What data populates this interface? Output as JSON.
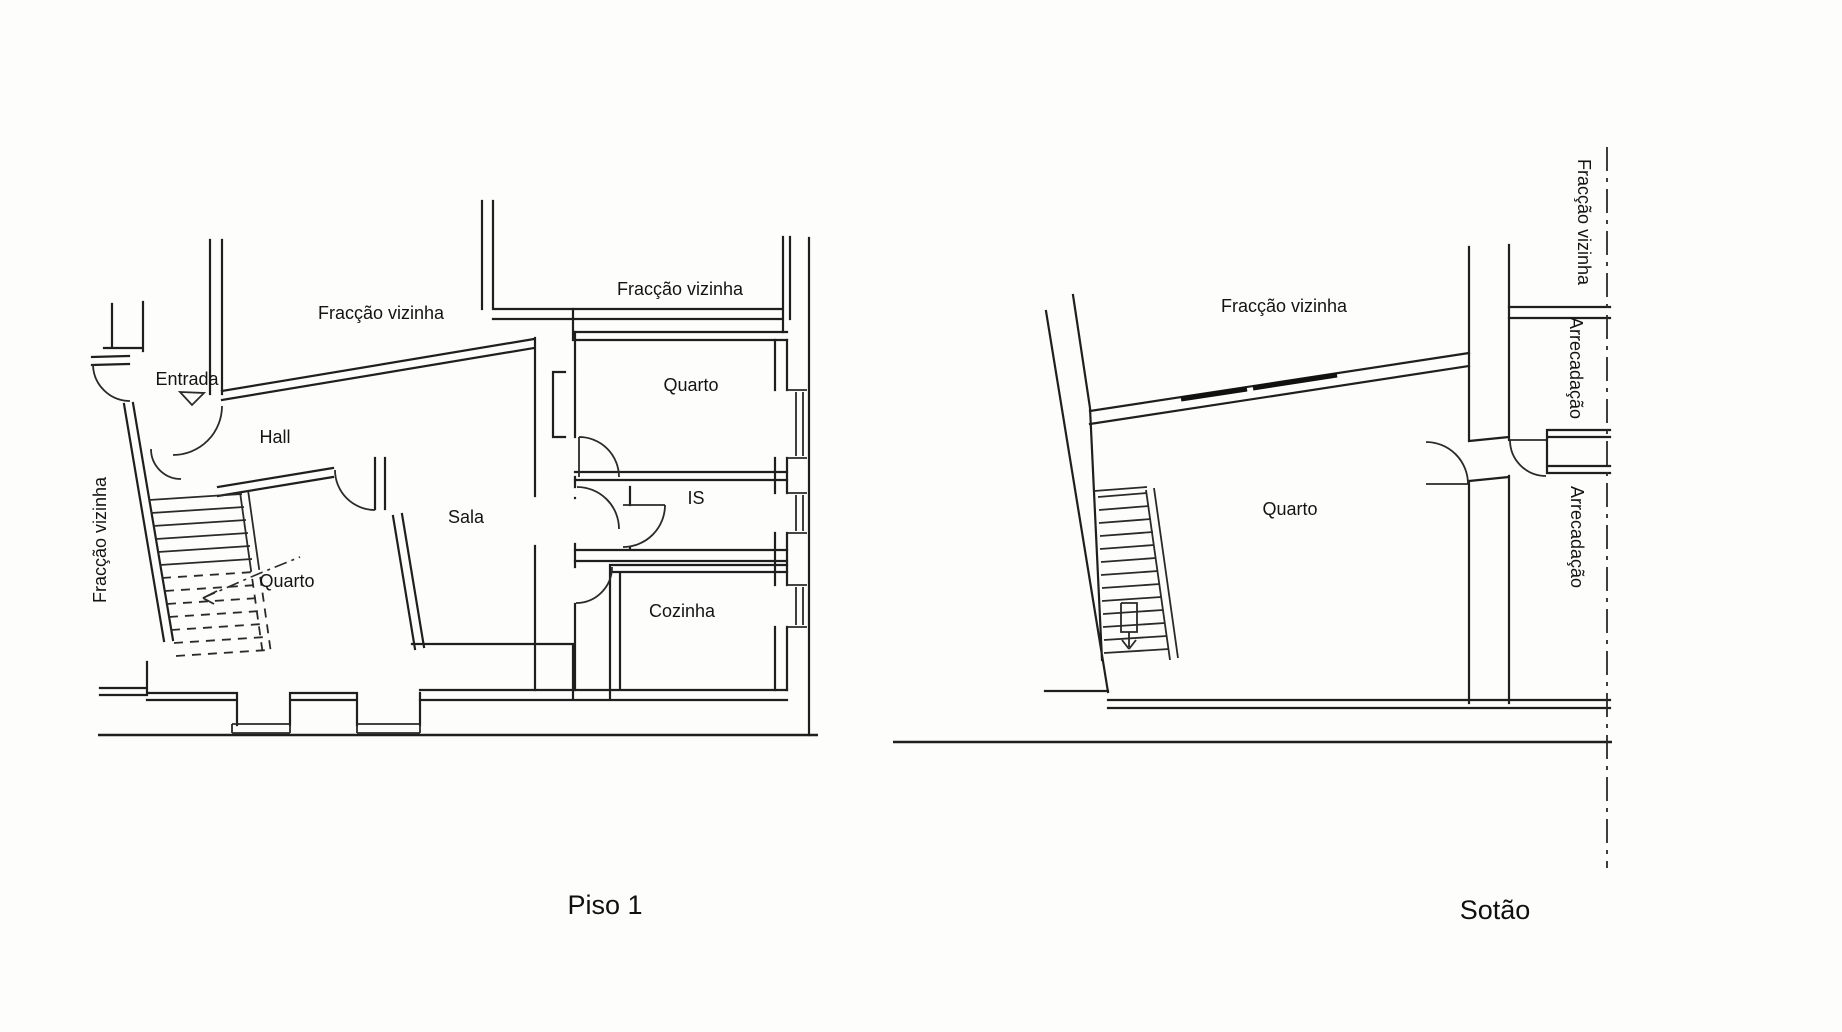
{
  "colors": {
    "paper": "#fdfdfc",
    "ink": "#1f1f1f"
  },
  "plan_piso1": {
    "title": "Piso 1",
    "labels": {
      "fraccao_vizinha_left": "Fracção vizinha",
      "fraccao_vizinha_top": "Fracção vizinha",
      "fraccao_vizinha_top_right": "Fracção vizinha",
      "entrada": "Entrada",
      "hall": "Hall",
      "quarto_left": "Quarto",
      "sala": "Sala",
      "quarto_right": "Quarto",
      "is": "IS",
      "cozinha": "Cozinha"
    }
  },
  "plan_sotao": {
    "title": "Sotão",
    "labels": {
      "fraccao_vizinha_top": "Fracção vizinha",
      "fraccao_vizinha_right": "Fracção vizinha",
      "arrecadacao_top": "Arrecadação",
      "quarto": "Quarto",
      "arrecadacao_bottom": "Arrecadação"
    }
  }
}
